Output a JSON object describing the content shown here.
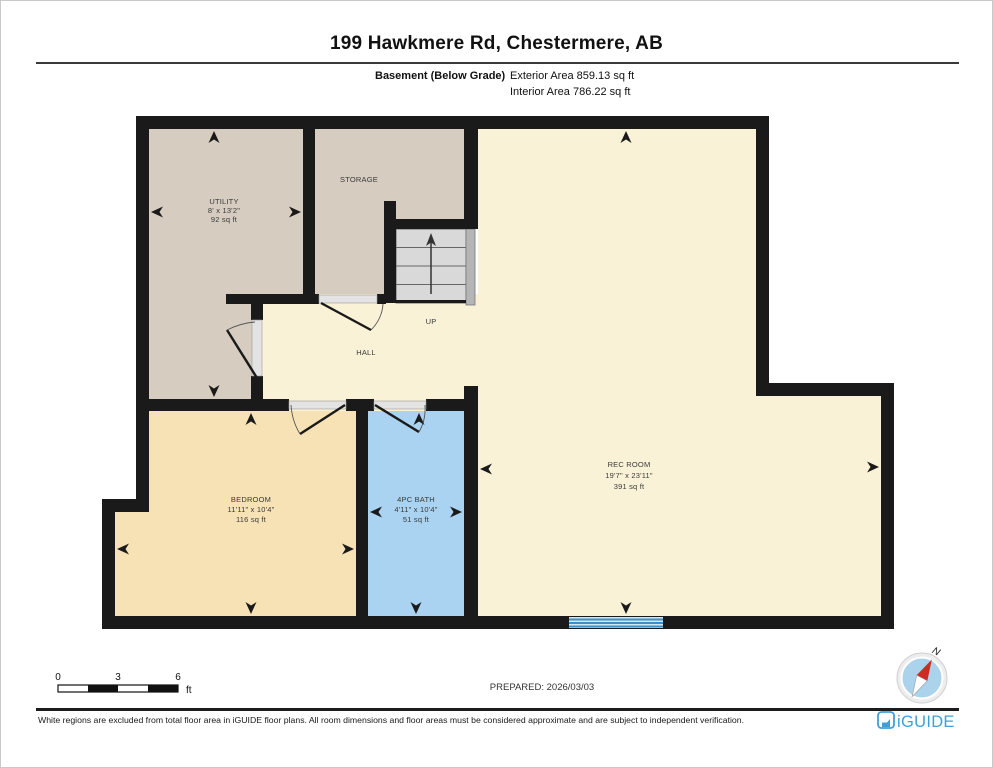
{
  "header": {
    "title": "199 Hawkmere Rd, Chestermere, AB",
    "floor_label": "Basement (Below Grade)",
    "exterior_area": "Exterior Area 859.13 sq ft",
    "interior_area": "Interior Area 786.22 sq ft"
  },
  "rooms": {
    "utility": {
      "name": "UTILITY",
      "dims": "8' x 13'2\"",
      "area": "92 sq ft"
    },
    "storage": {
      "name": "STORAGE"
    },
    "stairs": {
      "label": "UP"
    },
    "hall": {
      "name": "HALL"
    },
    "bedroom": {
      "name": "BEDROOM",
      "dims": "11'11\" x 10'4\"",
      "area": "116 sq ft"
    },
    "bath": {
      "name": "4PC BATH",
      "dims": "4'11\" x 10'4\"",
      "area": "51 sq ft"
    },
    "rec_room": {
      "name": "REC ROOM",
      "dims": "19'7\" x 23'11\"",
      "area": "391 sq ft"
    }
  },
  "scale_bar": {
    "start": "0",
    "mid": "3",
    "end": "6",
    "unit": "ft"
  },
  "prepared": "PREPARED: 2026/03/03",
  "compass": {
    "label": "N"
  },
  "footer": {
    "disclaimer": "White regions are excluded from total floor area in iGUIDE floor plans. All room dimensions and floor areas must be considered approximate and are subject to independent verification.",
    "brand": "iGUIDE"
  },
  "colors": {
    "wall": "#1a1a1a",
    "utility_floor": "#d6ccc0",
    "main_floor": "#faf2d7",
    "bedroom_floor": "#f7e2b6",
    "bath_floor": "#a9d3f0",
    "window_blue": "#3e8fc6",
    "window_bg": "#cfe8f7",
    "compass_red": "#cf2b20",
    "compass_blue": "#abd3ec",
    "brand_blue": "#3fa0d5"
  }
}
